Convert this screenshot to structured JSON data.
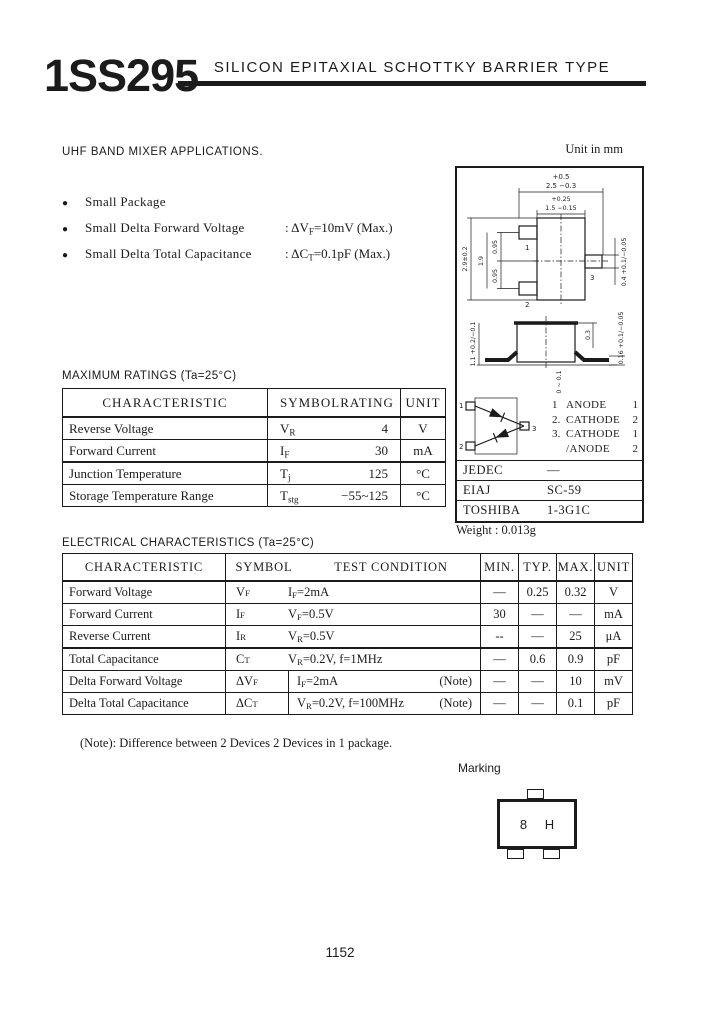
{
  "page": {
    "part_number": "1SS295",
    "title": "SILICON EPITAXIAL SCHOTTKY BARRIER TYPE",
    "application": "UHF BAND MIXER APPLICATIONS.",
    "unit_note": "Unit in mm",
    "page_number": "1152"
  },
  "features": [
    {
      "bullet": "●",
      "label": "Small Package",
      "value": ""
    },
    {
      "bullet": "●",
      "label": "Small Delta Forward Voltage",
      "value": ": ΔV_{F}=10mV (Max.)"
    },
    {
      "bullet": "●",
      "label": "Small Delta Total Capacitance",
      "value": ": ΔC_{T}=0.1pF (Max.)"
    }
  ],
  "maximum_ratings": {
    "heading": "MAXIMUM RATINGS (Ta=25°C)",
    "headers": {
      "characteristic": "CHARACTERISTIC",
      "symbol": "SYMBOL",
      "rating": "RATING",
      "unit": "UNIT"
    },
    "rows": [
      {
        "characteristic": "Reverse Voltage",
        "symbol": "V_{R}",
        "rating": "4",
        "unit": "V"
      },
      {
        "characteristic": "Forward Current",
        "symbol": "I_{F}",
        "rating": "30",
        "unit": "mA"
      },
      {
        "characteristic": "Junction Temperature",
        "symbol": "T_{j}",
        "rating": "125",
        "unit": "°C"
      },
      {
        "characteristic": "Storage Temperature Range",
        "symbol": "T_{stg}",
        "rating": "−55~125",
        "unit": "°C"
      }
    ]
  },
  "electrical_characteristics": {
    "heading": "ELECTRICAL CHARACTERISTICS (Ta=25°C)",
    "headers": {
      "characteristic": "CHARACTERISTIC",
      "symbol": "SYMBOL",
      "condition": "TEST CONDITION",
      "min": "MIN.",
      "typ": "TYP.",
      "max": "MAX.",
      "unit": "UNIT"
    },
    "rows": [
      {
        "characteristic": "Forward Voltage",
        "symbol": "V_{F}",
        "condition": "I_{F}=2mA",
        "note": "",
        "min": "—",
        "typ": "0.25",
        "max": "0.32",
        "unit": "V"
      },
      {
        "characteristic": "Forward Current",
        "symbol": "I_{F}",
        "condition": "V_{F}=0.5V",
        "note": "",
        "min": "30",
        "typ": "—",
        "max": "—",
        "unit": "mA"
      },
      {
        "characteristic": "Reverse Current",
        "symbol": "I_{R}",
        "condition": "V_{R}=0.5V",
        "note": "",
        "min": "--",
        "typ": "—",
        "max": "25",
        "unit": "μA"
      },
      {
        "characteristic": "Total Capacitance",
        "symbol": "C_{T}",
        "condition": "V_{R}=0.2V, f=1MHz",
        "note": "",
        "min": "—",
        "typ": "0.6",
        "max": "0.9",
        "unit": "pF"
      },
      {
        "characteristic": "Delta Forward Voltage",
        "symbol": "ΔV_{F}",
        "condition": "I_{F}=2mA",
        "note": "(Note)",
        "min": "—",
        "typ": "—",
        "max": "10",
        "unit": "mV"
      },
      {
        "characteristic": "Delta Total Capacitance",
        "symbol": "ΔC_{T}",
        "condition": "V_{R}=0.2V, f=100MHz",
        "note": "(Note)",
        "min": "—",
        "typ": "—",
        "max": "0.1",
        "unit": "pF"
      }
    ],
    "footnote": "(Note): Difference between 2 Devices 2 Devices in 1 package."
  },
  "package": {
    "pins": [
      "1",
      "2",
      "3"
    ],
    "pin_functions": [
      {
        "pin": "1",
        "function": "ANODE",
        "device": "1"
      },
      {
        "pin": "2.",
        "function": "CATHODE",
        "device": "2"
      },
      {
        "pin": "3.",
        "function": "CATHODE",
        "device": "1"
      },
      {
        "pin": "",
        "function": "/ANODE",
        "device": "2"
      }
    ],
    "codes": [
      {
        "standard": "JEDEC",
        "code": "—"
      },
      {
        "standard": "EIAJ",
        "code": "SC-59"
      },
      {
        "standard": "TOSHIBA",
        "code": "1-3G1C"
      }
    ],
    "weight": "Weight : 0.013g",
    "dimensions": {
      "width_plus": "+0.5",
      "width": "2.5 −0.3",
      "body_width_plus": "+0.25",
      "body_width": "1.5 −0.15",
      "height": "2.9±0.2",
      "lead_span": "1.9",
      "pitch_upper": "0.95",
      "pitch_lower": "0.95",
      "lead_width": "0.4 +0.1/−0.05",
      "side_height": "1.1 +0.2/−0.1",
      "side_top": "0.3",
      "lead_thickness": "0.16 +0.1/−0.05",
      "standoff": "0 ~ 0.1"
    }
  },
  "marking": {
    "heading": "Marking",
    "code": "8 H"
  }
}
